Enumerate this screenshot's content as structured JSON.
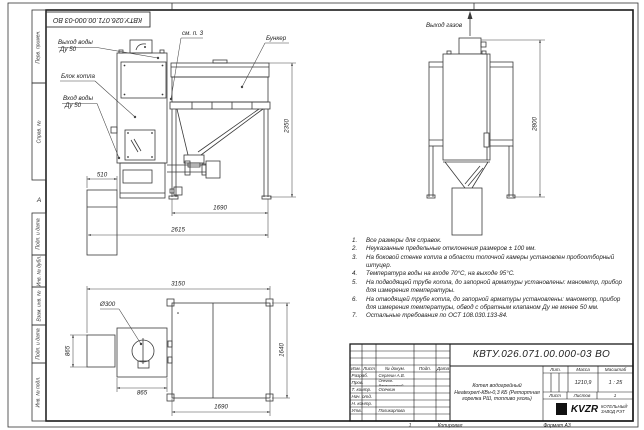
{
  "frame": {
    "corner_doc_number": "КВТУ.026.071.00.000-03 ВО",
    "zone_marker": "А",
    "stamps": [
      "Перв. примен.",
      "Справ. №",
      "Подп. и дата",
      "Инв. № дубл.",
      "Взам. инв. №",
      "Подп. и дата",
      "Инв. № подл."
    ]
  },
  "views": {
    "front": {
      "label_water_out_1": "Выход воды",
      "label_water_out_2": "Ду 50",
      "label_boiler": "Блок котла",
      "label_water_in_1": "Вход воды",
      "label_water_in_2": "Ду 50",
      "label_see_note": "см. п. 3",
      "label_hopper": "Бункер",
      "dim_510": "510",
      "dim_1690": "1690",
      "dim_2615": "2615",
      "dim_2350": "2350"
    },
    "side": {
      "label_gas_out": "Выход газов",
      "dim_2800": "2800"
    },
    "top": {
      "label_diameter": "Ø300",
      "dim_3150": "3150",
      "dim_865_left": "865",
      "dim_865_bottom": "865",
      "dim_1690": "1690",
      "dim_1640": "1640"
    }
  },
  "notes": [
    {
      "num": "1.",
      "text": "Все размеры для справок."
    },
    {
      "num": "2.",
      "text": "Неуказанные предельные отклонения размеров ± 100 мм."
    },
    {
      "num": "3.",
      "text": "На боковой стенке котла в области топочной камеры установлен пробоотборный штуцер."
    },
    {
      "num": "4.",
      "text": "Температура воды на входе 70°С, на выходе 95°С."
    },
    {
      "num": "5.",
      "text": "На подводящей трубе котла, до запорной арматуры установлены: манометр, прибор для измерения температуры."
    },
    {
      "num": "6.",
      "text": "На отводящей трубе котла, до запорной арматуры установлены: манометр, прибор для измерения температуры, обвод с обратным клапаном Ду не менее 50 мм."
    },
    {
      "num": "7.",
      "text": "Остальные требования по ОСТ 108.030.133-84."
    }
  ],
  "title_block": {
    "doc_number": "КВТУ.026.071.00.000-03 ВО",
    "name_line1": "Котел водогрейный",
    "name_line2": "Heatexpert-КВн-0,3 КБ (Ретортная",
    "name_line3": "горелка РШ, топливо уголь)",
    "col_izm": "Изм.",
    "col_list": "Лист",
    "col_doc": "№ докум.",
    "col_podp": "Подп.",
    "col_data": "Дата",
    "roles": [
      {
        "role": "Разраб.",
        "name": "Сергеин А.В."
      },
      {
        "role": "Пров.",
        "name": "Онегов-Верещинский"
      },
      {
        "role": "Т. контр.",
        "name": "Осечкин"
      },
      {
        "role": "Нач. отд.",
        "name": ""
      },
      {
        "role": "Н. контр.",
        "name": ""
      },
      {
        "role": "Утв.",
        "name": "Поликарпова"
      }
    ],
    "lit_label": "Лит.",
    "mass_label": "Масса",
    "scale_label": "Масштаб",
    "mass_value": "1210,9",
    "scale_value": "1 : 25",
    "list_label": "Лист",
    "listov_label": "Листов",
    "listov_value": "1",
    "logo_text": "KVZR",
    "company_line1": "КОТЕЛЬНЫЙ",
    "company_line2": "ЗАВОД РЭТ",
    "copy_index": "1",
    "copied_label": "Копировал",
    "format_label": "Формат А3"
  }
}
